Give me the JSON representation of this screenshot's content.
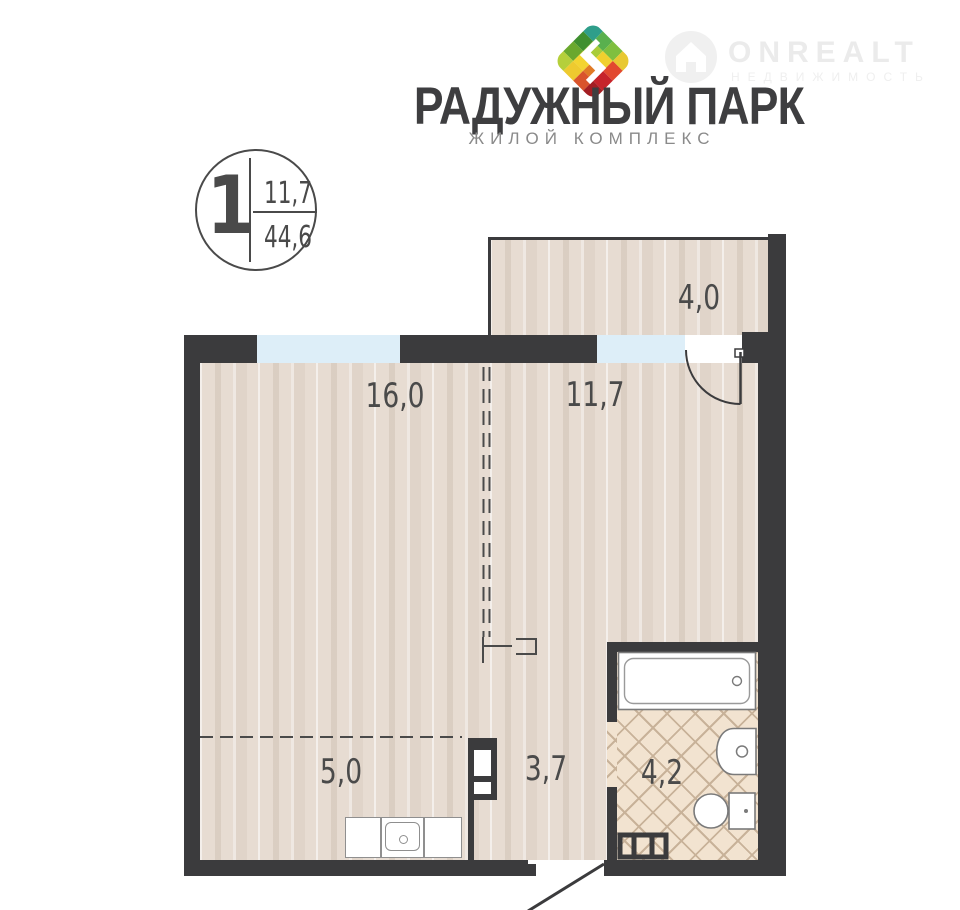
{
  "header": {
    "title": "РАДУЖНЫЙ ПАРК",
    "subtitle": "ЖИЛОЙ  КОМПЛЕКС",
    "watermark": {
      "brand": "ONREALT",
      "tagline": "НЕДВИЖИМОСТЬ"
    }
  },
  "badge": {
    "rooms_count": "1",
    "living_area": "11,7",
    "total_area": "44,6"
  },
  "plan": {
    "rooms": [
      {
        "name": "loggia",
        "area": "4,0"
      },
      {
        "name": "living-room",
        "area": "16,0"
      },
      {
        "name": "room",
        "area": "11,7"
      },
      {
        "name": "kitchen",
        "area": "5,0"
      },
      {
        "name": "hallway",
        "area": "3,7"
      },
      {
        "name": "bathroom",
        "area": "4,2"
      }
    ],
    "colors": {
      "wall": "#3b3b3d",
      "window": "#ddeef8",
      "floor": "#e7dcd2",
      "tile": "#f2e3d0",
      "label": "#4a4a4a"
    }
  }
}
